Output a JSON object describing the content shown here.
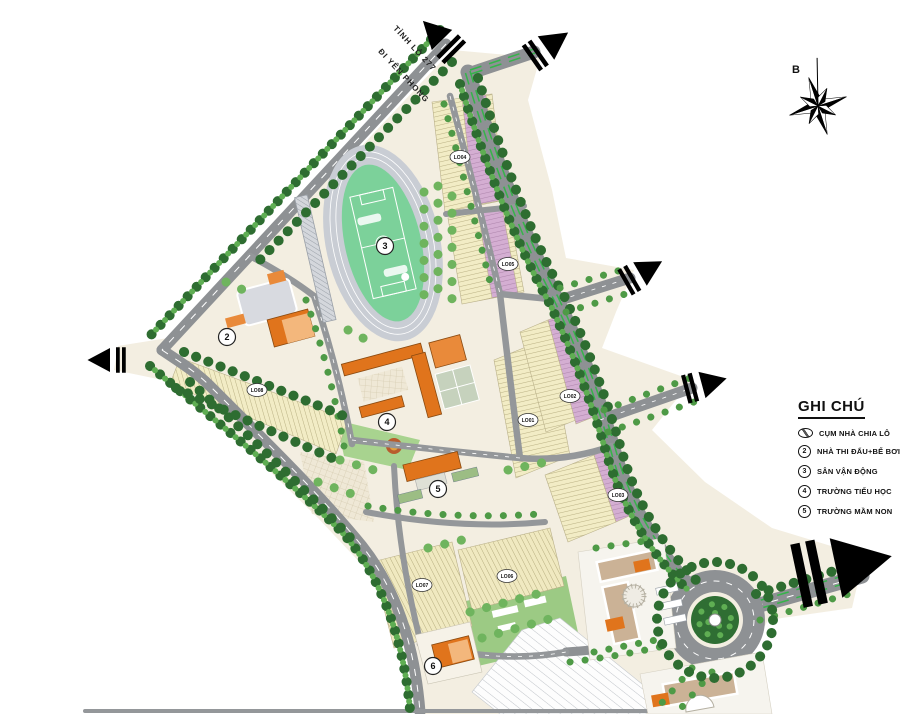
{
  "map": {
    "road_labels": {
      "line1": "TỈNH LỘ 277",
      "line2": "ĐI YÊN PHONG"
    },
    "compass": {
      "north_label": "B"
    },
    "markers": [
      "2",
      "3",
      "4",
      "5",
      "6"
    ],
    "lots": [
      "LO04",
      "LO05",
      "LO08",
      "LO01",
      "LO02",
      "LO03",
      "LO07",
      "LO06"
    ]
  },
  "legend": {
    "title": "GHI CHÚ",
    "items": [
      {
        "symbol": "oval",
        "label": "CỤM NHÀ CHIA LÔ"
      },
      {
        "symbol": "2",
        "label": "NHÀ THI ĐẤU+BỂ BƠI"
      },
      {
        "symbol": "3",
        "label": "SÂN VẬN ĐỘNG"
      },
      {
        "symbol": "4",
        "label": "TRƯỜNG TIỂU HỌC"
      },
      {
        "symbol": "5",
        "label": "TRƯỜNG MẦM NON"
      }
    ]
  },
  "colors": {
    "road": "#8e9194",
    "land": "#f3eee1",
    "lot_yellow": "#f2ecc5",
    "lot_pink": "#d4aed2",
    "median_green": "#35b44a",
    "tree_dark": "#2e6d31",
    "tree_light": "#5fae53",
    "building_orange": "#e0741c"
  }
}
